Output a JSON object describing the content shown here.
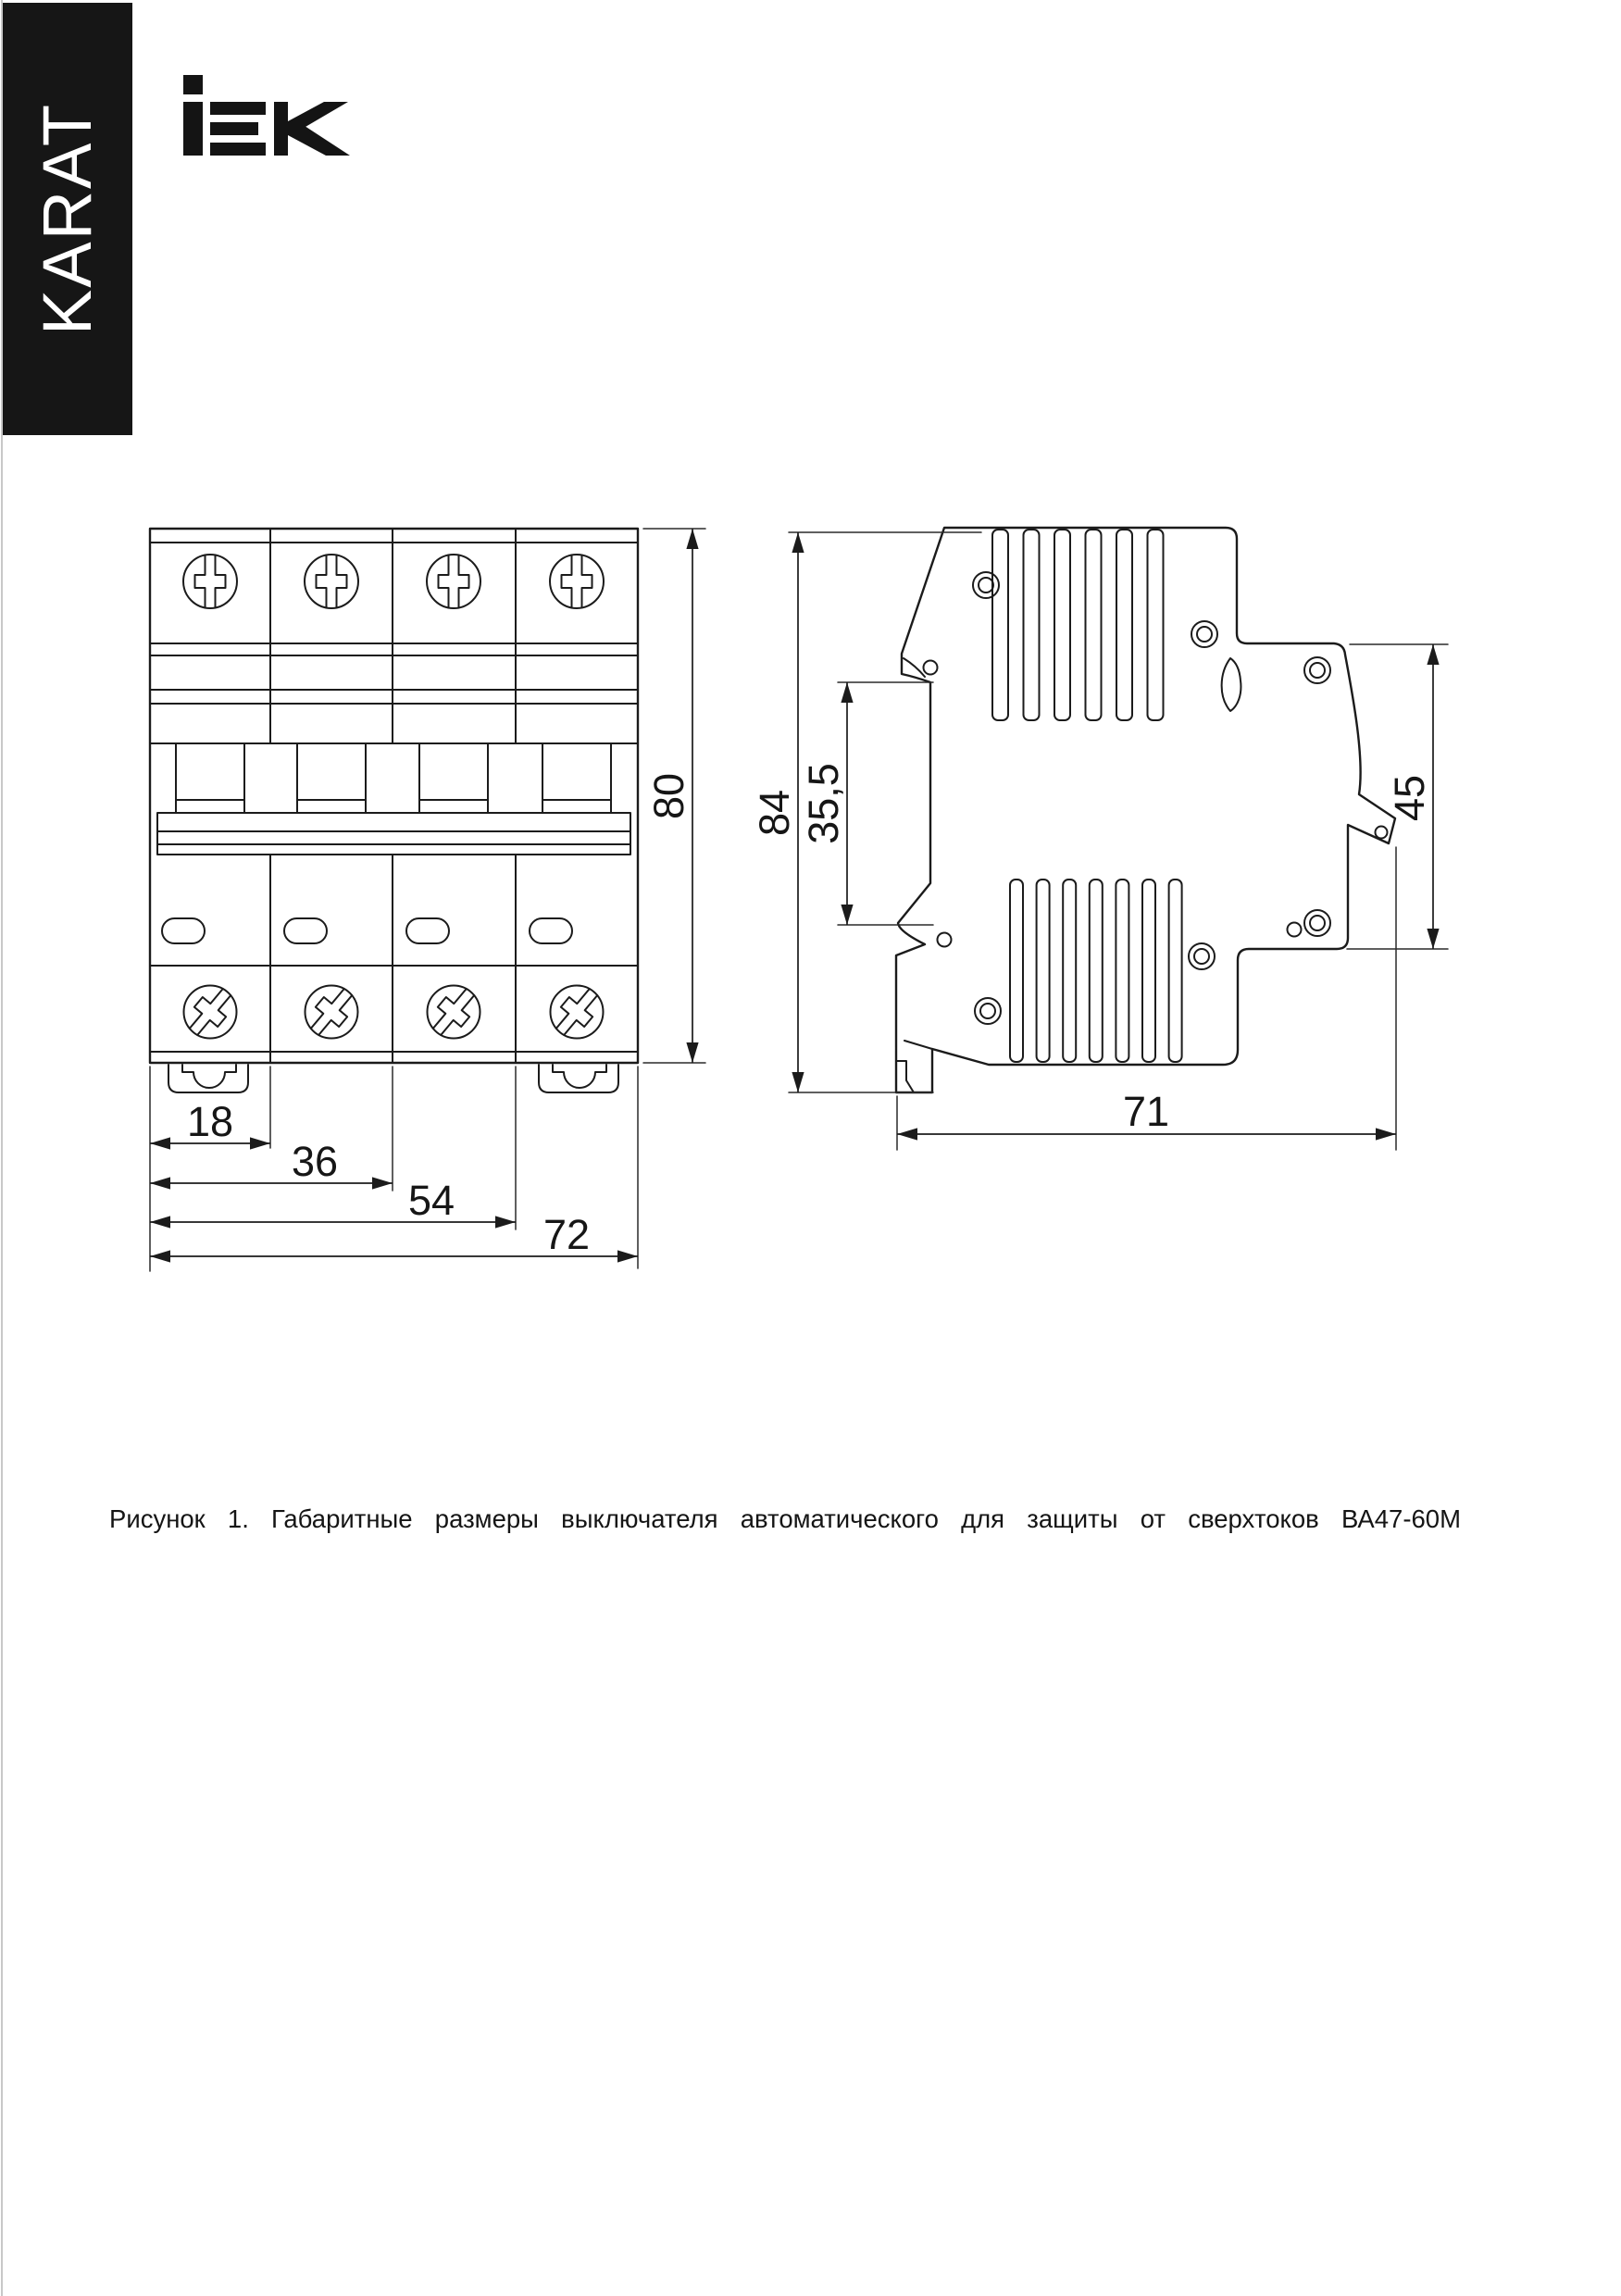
{
  "header": {
    "karat_label": "KARAT",
    "iek_logo_label": "IEK"
  },
  "drawing": {
    "front_view": {
      "dim_height": "80",
      "dim_module_1": "18",
      "dim_module_2": "36",
      "dim_module_3": "54",
      "dim_width": "72"
    },
    "side_view": {
      "dim_height": "84",
      "dim_din_recess": "35,5",
      "dim_terminal_zone": "45",
      "dim_depth": "71"
    }
  },
  "caption": "Рисунок 1. Габаритные размеры выключателя автоматического для защиты от сверхтоков ВА47-60М"
}
